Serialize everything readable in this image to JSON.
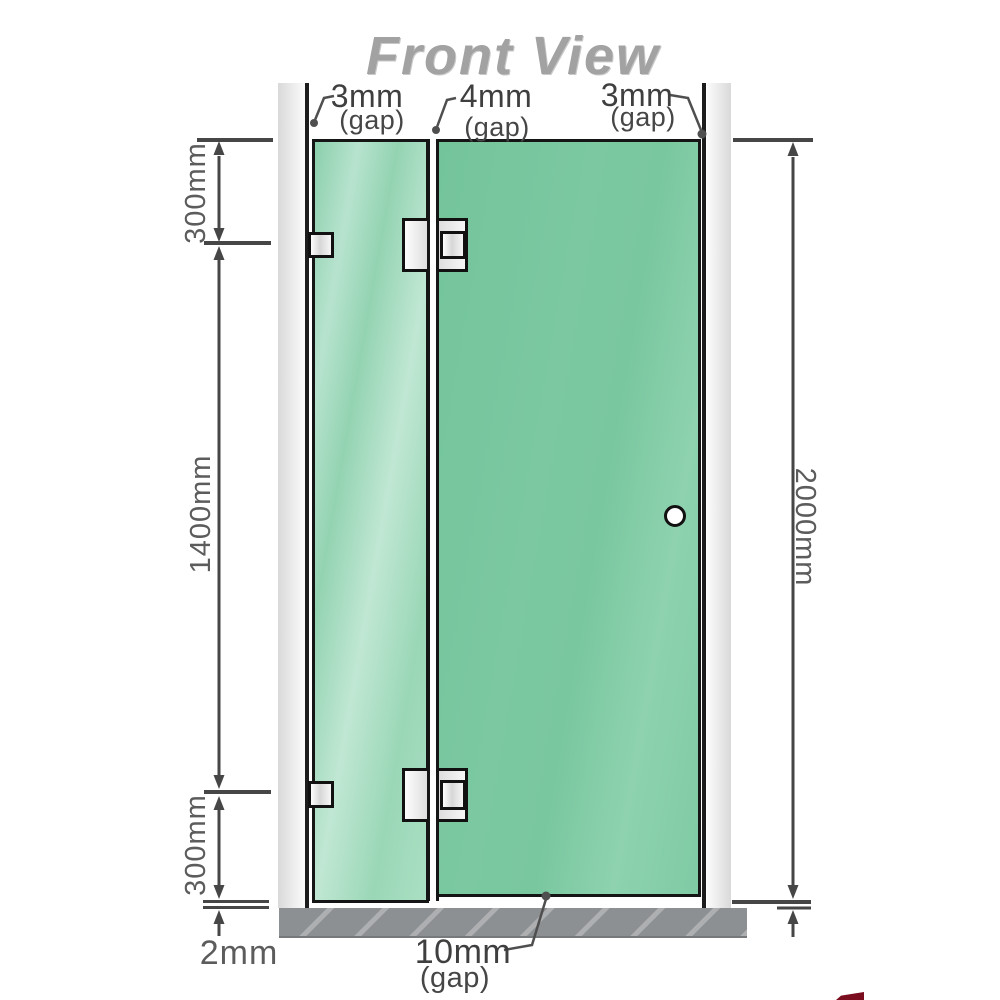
{
  "title": "Front View",
  "labels": {
    "dim_top_left": "300mm",
    "dim_mid_left": "1400mm",
    "dim_bottom_left": "300mm",
    "dim_floor_gap": "2mm",
    "dim_right_height": "2000mm",
    "gap_left_value": "3mm",
    "gap_left_unit": "(gap)",
    "gap_middle_value": "4mm",
    "gap_middle_unit": "(gap)",
    "gap_right_value": "3mm",
    "gap_right_unit": "(gap)",
    "gap_bottom_value": "10mm",
    "gap_bottom_unit": "(gap)"
  },
  "colors": {
    "glass_green": "#7cc8a2",
    "glass_highlight": "#b7e3ce",
    "wall_gray": "#e6e6e6",
    "floor_gray": "#8d9093",
    "outline_black": "#151515",
    "dimension_gray": "#4a4a4a",
    "title_gray": "#a2a2a2",
    "hardware_silver": "#e9e9e9",
    "logo_red": "#7a0e1f"
  }
}
